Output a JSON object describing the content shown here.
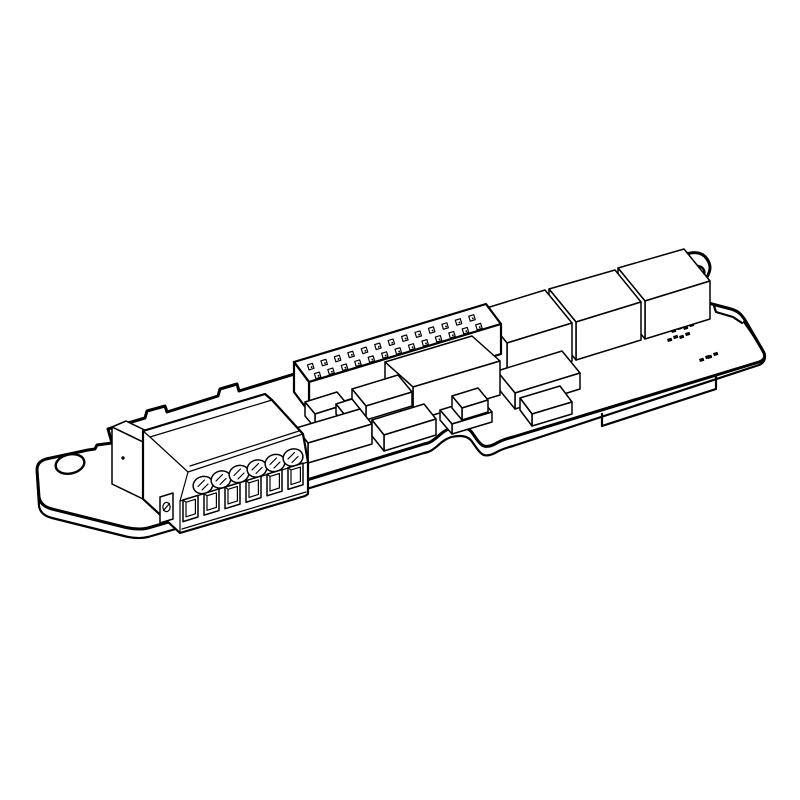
{
  "page": {
    "background": "#ffffff"
  },
  "colors": {
    "line": "#000000",
    "fill": "#ffffff"
  },
  "illustration": {
    "subject": "Isometric line drawing of a plug-in PCB option card",
    "style": "black outline on white, no shading, no text labels"
  },
  "parts": {
    "mounting_tab": {
      "holes": 1
    },
    "board_tab": {
      "holes": 1
    },
    "terminal_block": {
      "poles": 6,
      "screws": 6,
      "wire_openings": 6
    },
    "pin_header": {
      "rows": 2,
      "pins_per_row": 13
    },
    "large_ics": 3,
    "smd_pad_pairs": 6
  }
}
